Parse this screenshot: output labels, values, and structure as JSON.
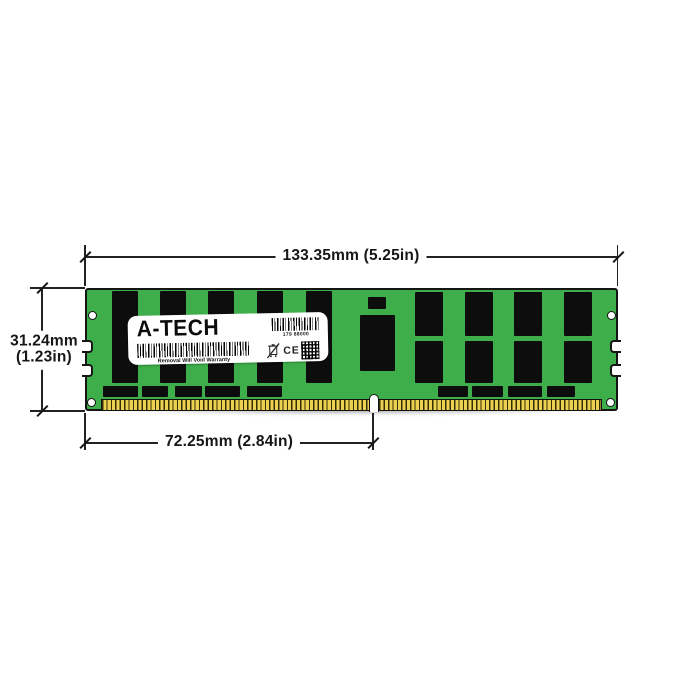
{
  "figure": {
    "type": "product-dimension-diagram",
    "subject": "DDR4 LRDIMM server memory module"
  },
  "dimensions": {
    "width_label": "133.35mm (5.25in)",
    "height_mm": "31.24mm",
    "height_in": "(1.23in)",
    "pin_width_label": "72.25mm (2.84in)"
  },
  "module_label": {
    "brand": "A-TECH",
    "serial_number": "179 88000",
    "warranty_text": "Removal Will Void Warranty",
    "ce_mark": "CE"
  },
  "colors": {
    "background": "#ffffff",
    "pcb_green": "#3eae4a",
    "chip_black": "#0d0d0d",
    "pin_gold": "#ecd04f",
    "dimension_line": "#222222",
    "label_white": "#ffffff"
  },
  "icons": {
    "barcode_small": "barcode-icon",
    "barcode_wide": "barcode-icon",
    "qr": "qr-code-icon",
    "weee": "weee-crossed-bin-icon"
  }
}
